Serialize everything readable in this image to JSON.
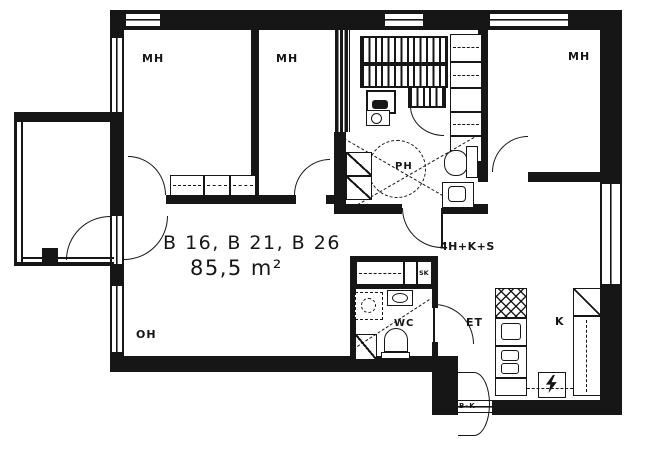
{
  "labels": {
    "units": "B 16, B 21, B 26",
    "area": "85,5 m²",
    "apartment_type": "4H+K+S",
    "entry_code": "B-K"
  },
  "rooms": {
    "bedroom_abbr": "MH",
    "living_room_abbr": "OH",
    "kitchen_abbr": "K",
    "washroom_abbr": "PH",
    "toilet_abbr": "WC",
    "entry_hall_abbr": "ET",
    "cleaning_closet_abbr": "SK"
  },
  "colors": {
    "ink": "#161616",
    "paper": "#ffffff",
    "frame": "#c9c9c9"
  }
}
